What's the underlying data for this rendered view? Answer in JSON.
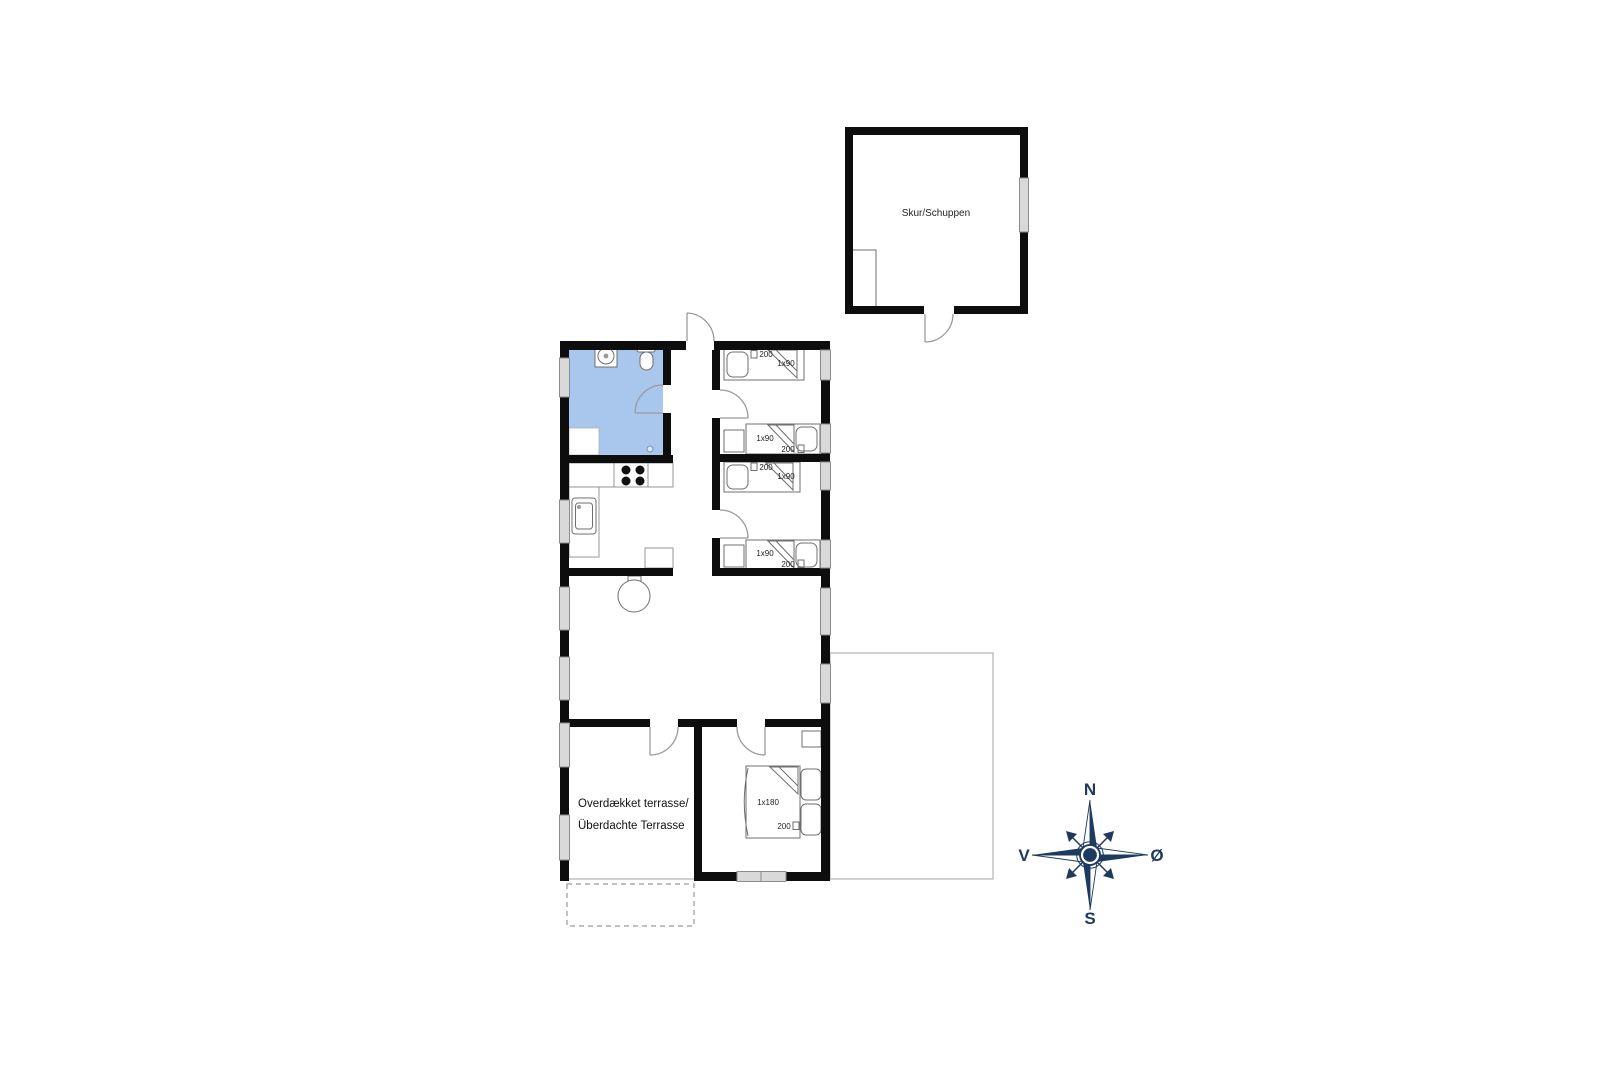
{
  "shed": {
    "label": "Skur/Schuppen"
  },
  "house": {
    "bedroom1": {
      "bed_top": {
        "length": "200",
        "size": "1x90"
      },
      "bed_bottom": {
        "size": "1x90",
        "length": "200"
      }
    },
    "bedroom2": {
      "bed_top": {
        "length": "200",
        "size": "1x90"
      },
      "bed_bottom": {
        "size": "1x90",
        "length": "200"
      }
    },
    "master_bedroom": {
      "bed": {
        "size": "1x180",
        "length": "200"
      }
    },
    "covered_terrace": {
      "label_line1": "Overdækket terrasse/",
      "label_line2": "Überdachte Terrasse"
    }
  },
  "compass": {
    "north": "N",
    "east": "Ø",
    "south": "S",
    "west": "V"
  },
  "colors": {
    "wall": "#0d0d0d",
    "bathroom_floor": "#a9c6ec",
    "window_fill": "#d9d9d9",
    "line_gray": "#9a9a9a",
    "compass_navy": "#1e3a5f"
  }
}
